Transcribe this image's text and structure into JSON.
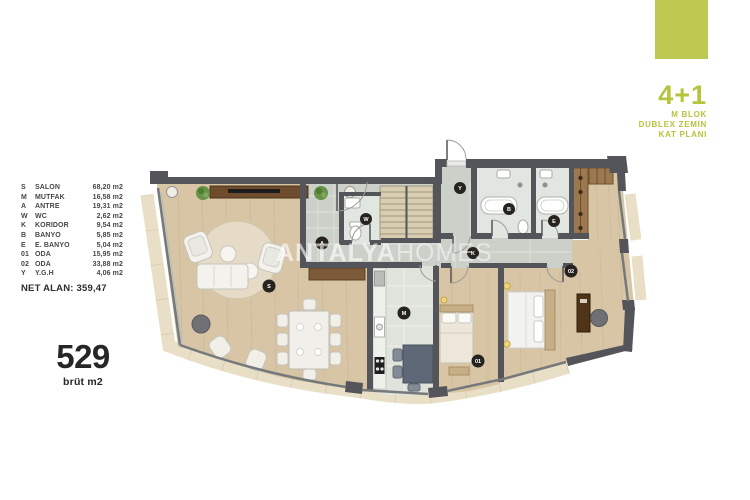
{
  "header": {
    "unit_type": "4+1",
    "block_lines": [
      "M BLOK",
      "DUBLEX ZEMIN",
      "KAT PLANI"
    ]
  },
  "legend": {
    "rows": [
      {
        "code": "S",
        "name": "SALON",
        "area": "68,20 m2"
      },
      {
        "code": "M",
        "name": "MUTFAK",
        "area": "16,58 m2"
      },
      {
        "code": "A",
        "name": "ANTRE",
        "area": "19,31 m2"
      },
      {
        "code": "W",
        "name": "WC",
        "area": "2,62 m2"
      },
      {
        "code": "K",
        "name": "KORIDOR",
        "area": "9,54 m2"
      },
      {
        "code": "B",
        "name": "BANYO",
        "area": "5,85 m2"
      },
      {
        "code": "E",
        "name": "E. BANYO",
        "area": "5,04 m2"
      },
      {
        "code": "01",
        "name": "ODA",
        "area": "15,95 m2"
      },
      {
        "code": "02",
        "name": "ODA",
        "area": "33,88 m2"
      },
      {
        "code": "Y",
        "name": "Y.G.H",
        "area": "4,06 m2"
      }
    ],
    "net_area": "NET ALAN: 359,47"
  },
  "gross": {
    "value": "529",
    "unit": "brüt m2"
  },
  "watermark": {
    "bold": "ANTALYA",
    "light": "HOMES"
  },
  "plan": {
    "badges": [
      "S",
      "M",
      "A",
      "W",
      "K",
      "B",
      "E",
      "01",
      "02",
      "Y"
    ]
  },
  "colors": {
    "accent_green": "#bdc951",
    "accent_green_text": "#b5c43c",
    "wall": "#54555a",
    "wood_floor": "#d7c5a6",
    "tile_floor": "#cbd1c9",
    "bath_floor": "#e2e6e0",
    "balcony_sill": "#e8dfc6"
  }
}
